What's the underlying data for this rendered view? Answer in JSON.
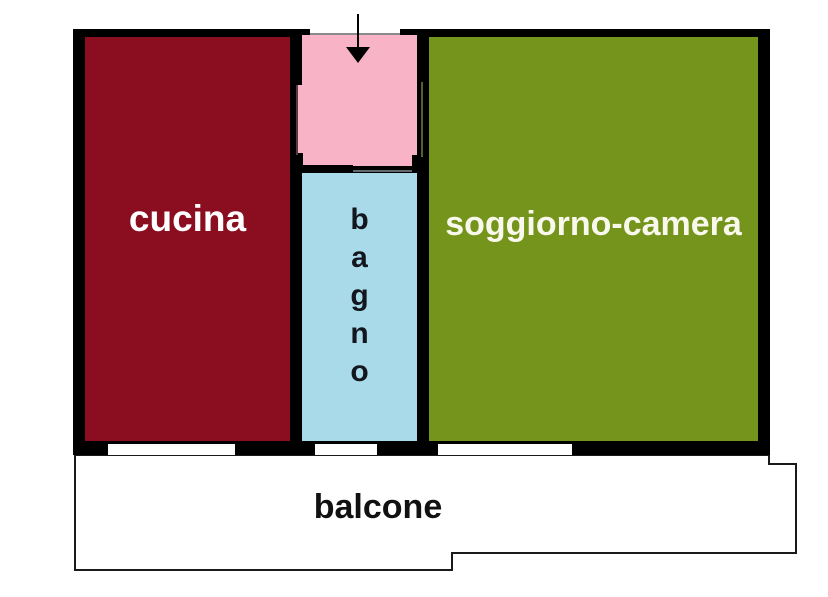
{
  "floorplan": {
    "type": "apartment-plan",
    "wall_color": "#000000",
    "background_color": "#FFFFFF",
    "entrance": {
      "arrow_direction": "down",
      "room_color": "#F8B4C6"
    },
    "rooms": {
      "cucina": {
        "label": "cucina",
        "color": "#8B0E20",
        "text_color": "#FFFFFF"
      },
      "bagno": {
        "label": "bagno",
        "label_stacked": "b\na\ng\nn\no",
        "color": "#A9DAEA",
        "text_color": "#13161C"
      },
      "soggiorno": {
        "label": "soggiorno-camera",
        "color": "#75941B",
        "text_color": "#F8F8EC"
      },
      "balcone": {
        "label": "balcone",
        "color": "#FFFFFF",
        "text_color": "#111111"
      }
    }
  }
}
